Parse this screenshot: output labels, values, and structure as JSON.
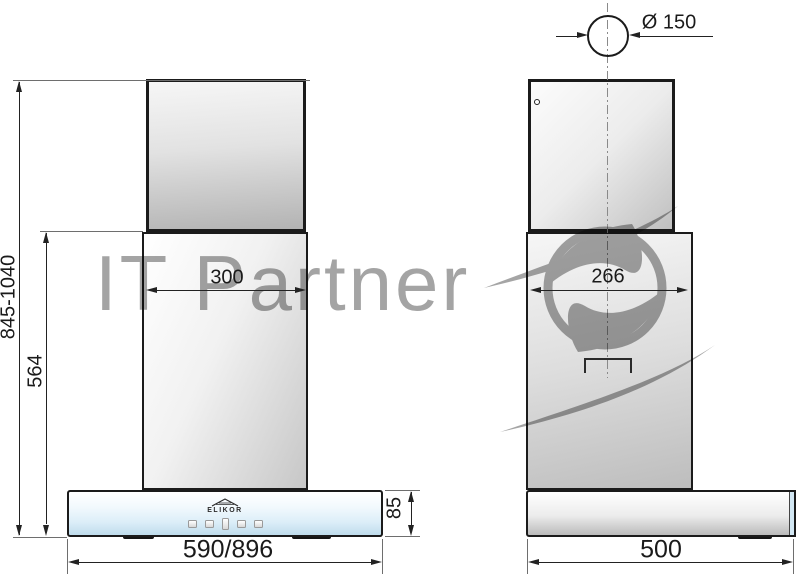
{
  "drawing": {
    "watermark": {
      "text": "IT Partner",
      "logo_icon": "s-swoosh-in-circle",
      "color": "#8d8d8d"
    },
    "front_view": {
      "brand": "ELIKOR",
      "total_height": "845-1040",
      "duct_section_height": "564",
      "chimney_width": "300",
      "body_width": "590/896",
      "body_height": "85",
      "controls": [
        "touch-button",
        "touch-button",
        "touch-display",
        "touch-button",
        "touch-button"
      ]
    },
    "side_view": {
      "duct_diameter": "Ø 150",
      "chimney_depth": "266",
      "body_depth": "500"
    },
    "colors": {
      "line": "#1b1b1b",
      "glass_blue": "#bfdcec",
      "metal_gray": "#b3b3b3"
    }
  }
}
